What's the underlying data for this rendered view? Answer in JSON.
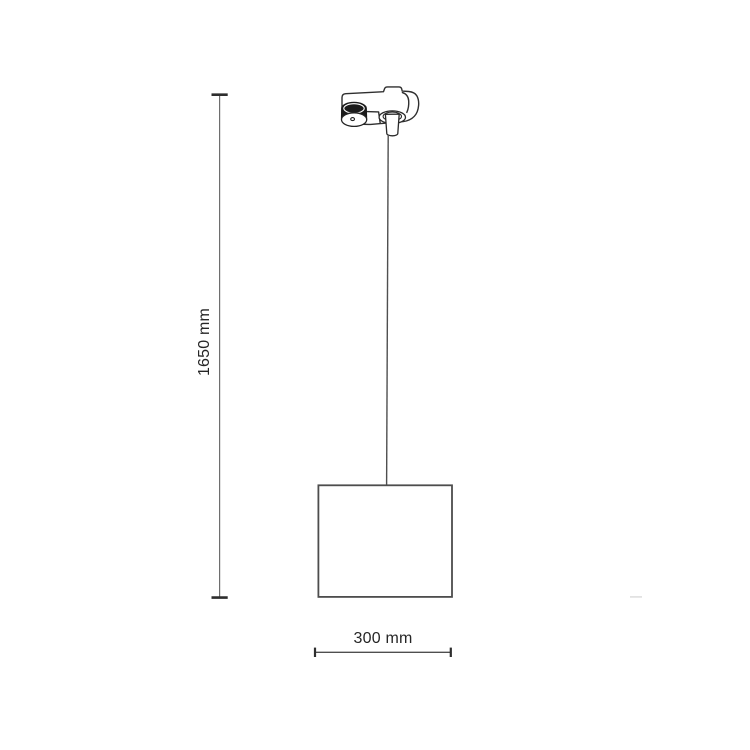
{
  "page": {
    "background": "#ffffff"
  },
  "diagram": {
    "type": "product-dimension-drawing",
    "subject": "track-mounted pendant lamp with square fabric shade",
    "parts": [
      "track-adapter",
      "suspension-cable",
      "lamp-shade"
    ],
    "dimensions": {
      "height_label": "1650 mm",
      "width_label": "300 mm"
    },
    "colors": {
      "outline": "#2f2f2f",
      "shade_outline": "#4d4d4d",
      "dimension_line": "#5f5f5f",
      "tick": "#2e2e2e",
      "text": "#262626",
      "knob_fill": "#1b1b1b",
      "background": "#ffffff"
    }
  }
}
